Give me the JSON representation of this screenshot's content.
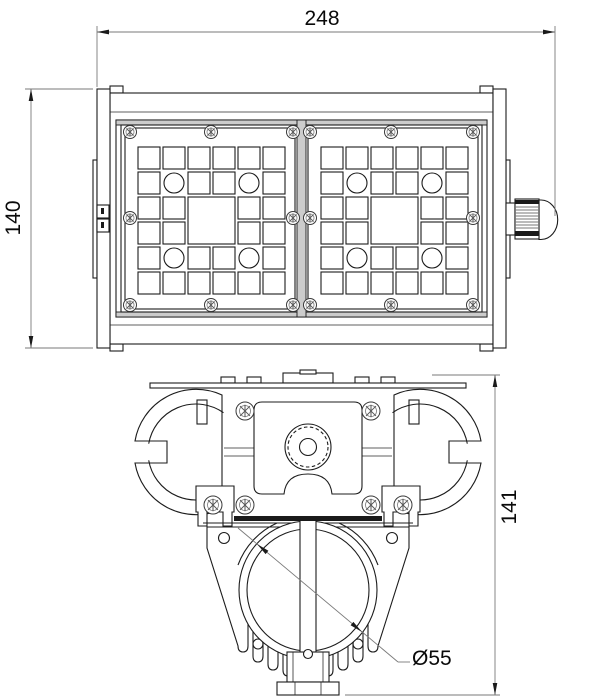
{
  "page": {
    "background": "#ffffff"
  },
  "drawing": {
    "description": "Two-view technical drawing of a linear LED floodlight: front elevation with two LED panels, and end cross-section of the extruded housing with heat sink",
    "dimensions": {
      "overall_width": "248",
      "overall_height": "140",
      "section_height": "141",
      "lens_diameter": "Ø55"
    },
    "colors": {
      "object_line": "#1c1c1c",
      "dimension_line": "#7a7a7a",
      "accent_gray": "#cccccc",
      "dark_fill": "#1a1a1a",
      "background": "#ffffff"
    }
  }
}
